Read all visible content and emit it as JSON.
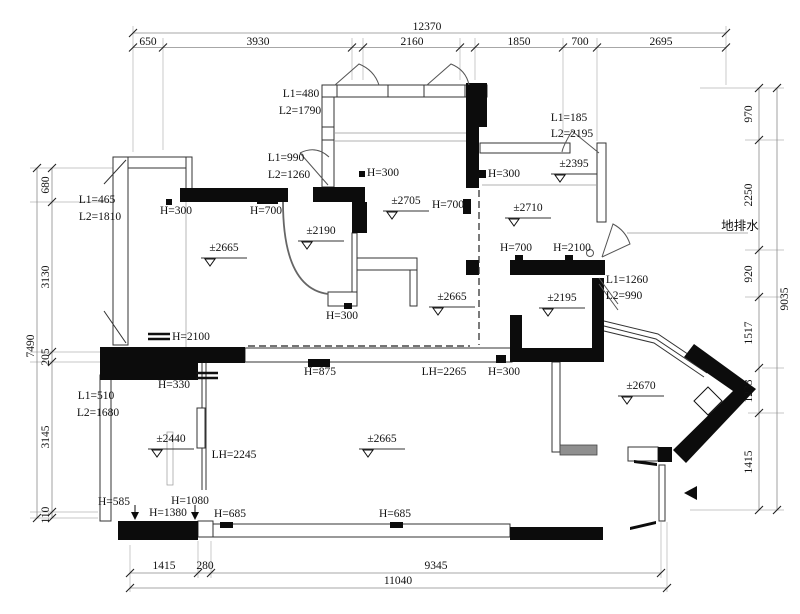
{
  "dims": {
    "top": {
      "overall": "12370",
      "segments": [
        "650",
        "3930",
        "2160",
        "1850",
        "700",
        "2695"
      ]
    },
    "left": {
      "overall": "7490",
      "segments": [
        "680",
        "3130",
        "205",
        "3145",
        "110"
      ]
    },
    "right": {
      "overall": "9035",
      "segments": [
        "970",
        "2250",
        "920",
        "1517",
        "1233",
        "1415"
      ]
    },
    "bottom": {
      "overall": "11040",
      "segments": [
        "1415",
        "280",
        "9345"
      ]
    }
  },
  "openings": {
    "win_top_left": {
      "l1": "L1=465",
      "l2": "L2=1810"
    },
    "door_balcony": {
      "l1": "L1=480",
      "l2": "L2=1790"
    },
    "door_bed1_balcony": {
      "l1": "L1=990",
      "l2": "L2=1260"
    },
    "door_master_corner": {
      "l1": "L1=185",
      "l2": "L2=2195"
    },
    "door_entry_inner": {
      "l1": "L1=1260",
      "l2": "L2=990"
    },
    "win_bottom_left": {
      "l1": "L1=510",
      "l2": "L2=1680"
    }
  },
  "heights": {
    "h300_living": "H=300",
    "h700_living": "H=700",
    "h2100_living": "H=2100",
    "h330": "H=330",
    "h300_dining": "H=300",
    "h700_dining": "H=700",
    "h300_counter": "H=300",
    "h875": "H=875",
    "lh2265": "LH=2265",
    "h300_hall": "H=300",
    "h300_master": "H=300",
    "h700_master": "H=700",
    "h2100_master": "H=2100",
    "h585": "H=585",
    "h1080": "H=1080",
    "h1380": "H=1380",
    "h685_a": "H=685",
    "h685_b": "H=685",
    "lh2245": "LH=2245"
  },
  "levels": {
    "living": "±2665",
    "arc_room": "±2190",
    "dining": "±2705",
    "closet": "±2395",
    "master": "±2710",
    "hall": "±2665",
    "bath": "±2195",
    "bay": "±2670",
    "bed2": "±2440",
    "family": "±2665"
  },
  "notes": {
    "floor_drain": "地排水"
  }
}
